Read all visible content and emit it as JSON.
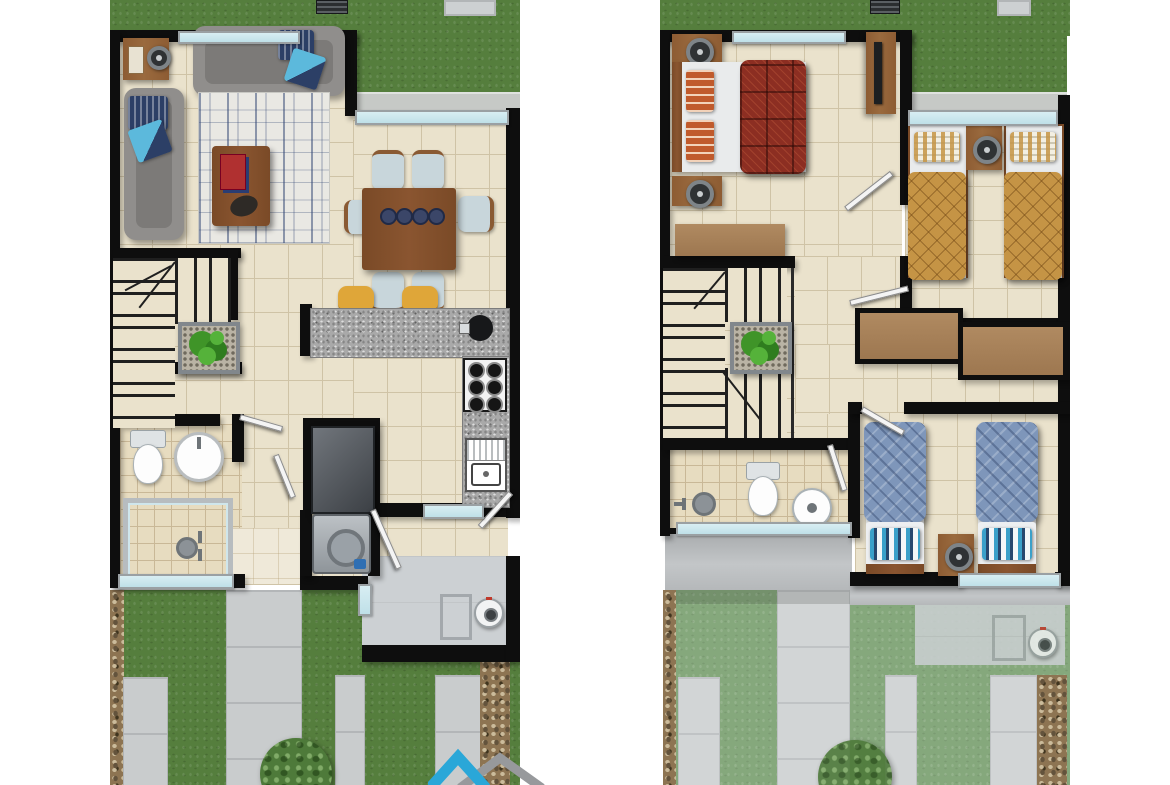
{
  "colors": {
    "wall": "#0e0e0e",
    "tile": "#eae2cc",
    "grout": "#cfc3a6",
    "bathtile": "#e7dcc0",
    "bathgrout": "#c9b897",
    "entry_tile": "#efe9d9",
    "grass": "#557e3d",
    "grass_faded": "#85a87c",
    "tree": "#4e7a3a",
    "curb": "#c6c9c6",
    "paver": "#c9cccd",
    "paver_faded": "#d2d5d6",
    "gravel": "#8d7452",
    "granite": "#a9a9a9",
    "wood_dark": "#7a4a27",
    "wood_mid": "#8d5c33",
    "wood_light": "#b08a61",
    "sofa": "#908e8c",
    "sofa_dark": "#7c7a78",
    "rug_base": "#e9e8e3",
    "stool": "#dfa639",
    "bed_red": "#8c2e22",
    "quilt_gold": "#c59445",
    "quilt_blue": "#7e96ba",
    "glass": "#bfe0e8",
    "frame": "#9aa0a3",
    "utility": "#ccd0d3",
    "logo_blue": "#2aa7d8",
    "logo_gray": "#97999c"
  },
  "plans": [
    {
      "name": "first-floor-plan",
      "zones": [
        "back-lawn",
        "back-patio",
        "living-room",
        "dining-room",
        "kitchen",
        "staircase",
        "bathroom",
        "laundry",
        "entry",
        "utility-patio",
        "front-garden"
      ],
      "furniture": [
        "sofa",
        "loveseat",
        "side-table",
        "table-lamp",
        "area-rug",
        "coffee-table",
        "magazines",
        "decor-plate",
        "dining-table",
        "dining-chairs-x6",
        "breakfast-bar",
        "bar-stools-x2",
        "stove",
        "kitchen-sink",
        "disposer",
        "refrigerator",
        "washing-machine",
        "toilet",
        "washbasin",
        "shower",
        "stair-planter",
        "water-heater",
        "tree"
      ]
    },
    {
      "name": "second-floor-plan",
      "zones": [
        "back-lawn",
        "back-patio-below",
        "master-bedroom",
        "bedroom-2",
        "bedroom-3",
        "hallway",
        "staircase",
        "bathroom",
        "closets",
        "roof-eave",
        "front-garden-below"
      ],
      "furniture": [
        "double-bed",
        "nightstands-x2",
        "table-lamps",
        "tv-console",
        "dresser",
        "single-beds-x2-gold",
        "nightstand",
        "closet",
        "closet",
        "single-beds-x2-blue",
        "nightstand",
        "toilet",
        "washbasin",
        "shower-head",
        "stair-planter",
        "water-heater",
        "tree"
      ]
    }
  ],
  "logo": {
    "name": "roof-chevron-logo"
  }
}
